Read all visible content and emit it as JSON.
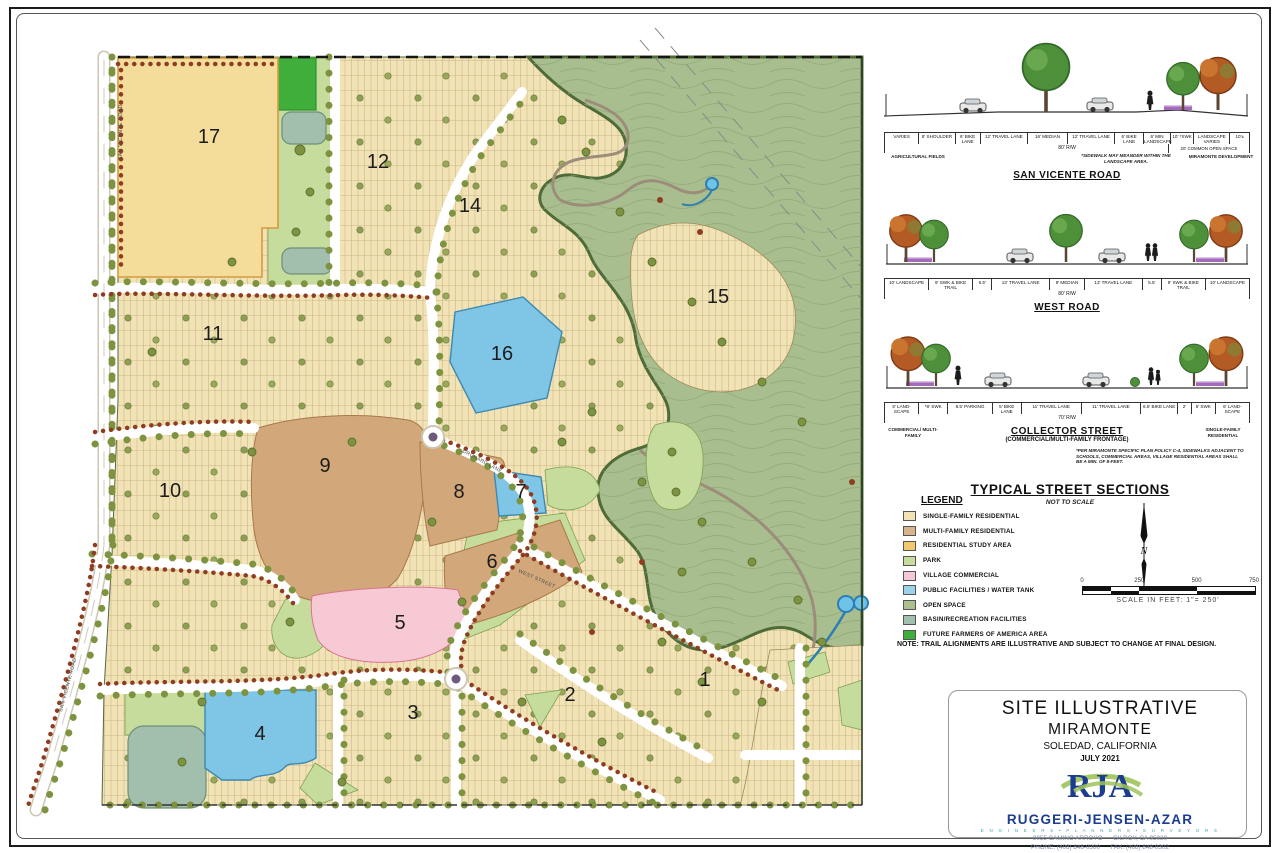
{
  "map": {
    "parcels": [
      {
        "n": "1",
        "x": 705,
        "y": 686
      },
      {
        "n": "2",
        "x": 570,
        "y": 701
      },
      {
        "n": "3",
        "x": 413,
        "y": 719
      },
      {
        "n": "4",
        "x": 260,
        "y": 740
      },
      {
        "n": "5",
        "x": 400,
        "y": 629
      },
      {
        "n": "6",
        "x": 492,
        "y": 568
      },
      {
        "n": "7",
        "x": 521,
        "y": 498
      },
      {
        "n": "8",
        "x": 459,
        "y": 498
      },
      {
        "n": "9",
        "x": 325,
        "y": 472
      },
      {
        "n": "10",
        "x": 170,
        "y": 497
      },
      {
        "n": "11",
        "x": 213,
        "y": 340
      },
      {
        "n": "12",
        "x": 378,
        "y": 168
      },
      {
        "n": "14",
        "x": 470,
        "y": 212
      },
      {
        "n": "15",
        "x": 718,
        "y": 303
      },
      {
        "n": "16",
        "x": 502,
        "y": 360
      },
      {
        "n": "17",
        "x": 209,
        "y": 143
      }
    ],
    "street_names": [
      {
        "t": "SAN VICENTE ROAD",
        "x": 122,
        "y": 160,
        "r": -90
      },
      {
        "t": "SAN VICENTE ROAD",
        "x": 62,
        "y": 712,
        "r": -75
      },
      {
        "t": "ORCHARD LANE",
        "x": 462,
        "y": 452,
        "r": 28
      },
      {
        "t": "WEST STREET",
        "x": 518,
        "y": 572,
        "r": 24
      }
    ]
  },
  "sections_header": {
    "title": "TYPICAL STREET SECTIONS",
    "note": "NOT TO SCALE"
  },
  "sections": [
    {
      "name": "SAN VICENTE ROAD",
      "rw": "80' R/W",
      "rw2": "20' COMMON OPEN SPACE",
      "note_left": "AGRICULTURAL FIELDS",
      "note_right1": "*SIDEWALK MAY MEANDER WITHIN THE LANDSCAPE AREA.",
      "note_right2": "MIRAMONTE DEVELOPMENT",
      "cl_label": "CL/ EX. R/W",
      "dims": [
        {
          "t": "VARIES",
          "w": 1.8
        },
        {
          "t": "8' SHOULDER",
          "w": 1.9
        },
        {
          "t": "6' BIKE LANE",
          "w": 1.3
        },
        {
          "t": "12' TRAVEL LANE",
          "w": 2.5
        },
        {
          "t": "16' MEDIAN",
          "w": 2.1
        },
        {
          "t": "12' TRAVEL LANE",
          "w": 2.5
        },
        {
          "t": "6' BIKE LANE",
          "w": 1.5
        },
        {
          "t": "6' MIN LANDSCAPE",
          "w": 1.4
        },
        {
          "t": "10' *SWK",
          "w": 1.2
        },
        {
          "t": "LANDSCAPE VARIES",
          "w": 1.9
        },
        {
          "t": "10'±",
          "w": 1.0
        }
      ]
    },
    {
      "name": "WEST ROAD",
      "rw": "80' R/W",
      "rw2": "",
      "note_left": "",
      "note_right1": "",
      "note_right2": "",
      "cl_label": "",
      "dims": [
        {
          "t": "10' LANDSCAPE",
          "w": 1.9
        },
        {
          "t": "9' SWK & BIKE TRAIL",
          "w": 1.9
        },
        {
          "t": "5.5'",
          "w": 0.8
        },
        {
          "t": "13' TRAVEL LANE",
          "w": 2.5
        },
        {
          "t": "9' MEDIAN",
          "w": 1.5
        },
        {
          "t": "13' TRAVEL LANE",
          "w": 2.5
        },
        {
          "t": "5.5'",
          "w": 0.8
        },
        {
          "t": "9' SWK & BIKE TRAIL",
          "w": 1.9
        },
        {
          "t": "10' LANDSCAPE",
          "w": 1.9
        }
      ]
    },
    {
      "name": "COLLECTOR STREET",
      "subtitle": "(COMMERCIAL/MULTI-FAMILY FRONTAGE)",
      "rw": "70' R/W",
      "rw2": "",
      "note_left": "COMMERCIAL/ MULTI-FAMILY",
      "note_right1": "SINGLE-FAMILY RESIDENTIAL",
      "note_right2": "",
      "cl_label": "",
      "footnote": "*PER MIRAMONTE SPECIFIC PLAN POLICY C-4, SIDEWALKS ADJACENT TO SCHOOLS, COMMERCIAL AREAS, VILLAGE RESIDENTIAL AREAS SHALL BE A MIN. OF 8-FEET.",
      "dims": [
        {
          "t": "6' LAND- SCAPE",
          "w": 1.3
        },
        {
          "t": "*8' SWK",
          "w": 1.1
        },
        {
          "t": "8.5' PARKING",
          "w": 1.7
        },
        {
          "t": "5' BIKE LANE",
          "w": 1.1
        },
        {
          "t": "11' TRAVEL LANE",
          "w": 2.3
        },
        {
          "t": "11' TRAVEL LANE",
          "w": 2.3
        },
        {
          "t": "6.5' BIKE LANE",
          "w": 1.4
        },
        {
          "t": "2'",
          "w": 0.5
        },
        {
          "t": "5' SWK",
          "w": 0.9
        },
        {
          "t": "6' LAND- SCAPE",
          "w": 1.3
        }
      ]
    }
  ],
  "legend": {
    "title": "LEGEND",
    "items": [
      {
        "label": "SINGLE-FAMILY RESIDENTIAL",
        "color": "#F2E3B7"
      },
      {
        "label": "MULTI-FAMILY RESIDENTIAL",
        "color": "#D8B48C"
      },
      {
        "label": "RESIDENTIAL STUDY AREA",
        "color": "#F2C96E"
      },
      {
        "label": "PARK",
        "color": "#C8DC9F"
      },
      {
        "label": "VILLAGE COMMERCIAL",
        "color": "#F5C9D4"
      },
      {
        "label": "PUBLIC FACILITIES / WATER TANK",
        "color": "#9CD2E8"
      },
      {
        "label": "OPEN SPACE",
        "color": "#ABC08F"
      },
      {
        "label": "BASIN/RECREATION FACILITIES",
        "color": "#A3BFAD"
      },
      {
        "label": "FUTURE FARMERS OF AMERICA AREA",
        "color": "#3FAE3B"
      }
    ]
  },
  "scale": {
    "ticks": [
      "0",
      "250",
      "500",
      "750"
    ],
    "caption": "SCALE IN FEET: 1\"= 250'"
  },
  "note": "NOTE: TRAIL ALIGNMENTS ARE ILLUSTRATIVE AND SUBJECT TO CHANGE AT FINAL DESIGN.",
  "north_label": "N",
  "titleblock": {
    "line1": "SITE ILLUSTRATIVE",
    "line2": "MIRAMONTE",
    "line3": "SOLEDAD, CALIFORNIA",
    "date": "JULY 2021",
    "logo": "RJA",
    "firm": "RUGGERI-JENSEN-AZAR",
    "tagline": "E N G I N E E R S   •   P L A N N E R S   •   S U R V E Y O R S",
    "addr1": "8055 CAMINO ARROYO      GILROY, CA 95020",
    "addr2": "PHONE: (408) 848-0300      FAX: (408) 848-0302"
  },
  "colors": {
    "single_family": "#F2E3B7",
    "multi_family": "#D2A87A",
    "study_area": "#F4DC9A",
    "park": "#C6DC9C",
    "commercial": "#F6C9D4",
    "public": "#7FC6E6",
    "open_space": "#A9BE8E",
    "basin": "#A2BEAC",
    "ffa": "#3FAE3B",
    "street_tree": "#7E9340",
    "shrub": "#8F3D22",
    "firm_blue": "#1B3C8F",
    "logo_green": "#9CC35A"
  }
}
